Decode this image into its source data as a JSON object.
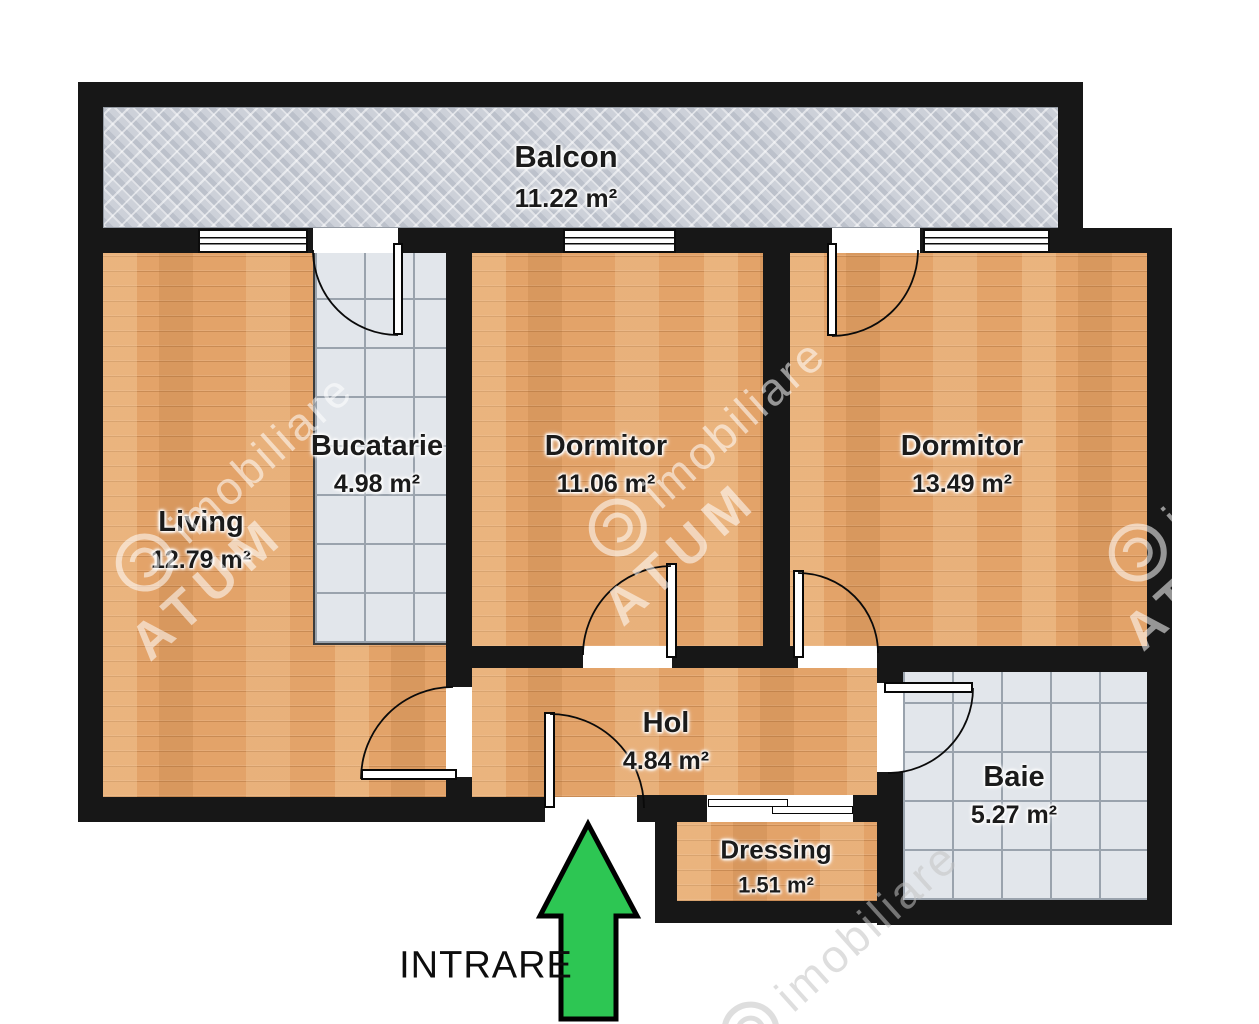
{
  "plan": {
    "entrance_label": "INTRARE",
    "rooms": [
      {
        "id": "balcon",
        "name": "Balcon",
        "area": "11.22 m²"
      },
      {
        "id": "living",
        "name": "Living",
        "area": "12.79 m²"
      },
      {
        "id": "bucatarie",
        "name": "Bucatarie",
        "area": "4.98 m²"
      },
      {
        "id": "dormitor1",
        "name": "Dormitor",
        "area": "11.06 m²"
      },
      {
        "id": "dormitor2",
        "name": "Dormitor",
        "area": "13.49 m²"
      },
      {
        "id": "hol",
        "name": "Hol",
        "area": "4.84 m²"
      },
      {
        "id": "baie",
        "name": "Baie",
        "area": "5.27 m²"
      },
      {
        "id": "dressing",
        "name": "Dressing",
        "area": "1.51 m²"
      }
    ]
  },
  "watermark": {
    "brand": "ATUM",
    "suffix": "imobiliare"
  },
  "colors": {
    "wall": "#171717",
    "wood": "#e3a369",
    "tile_bg": "#e2e6eb",
    "tile_grid": "#9aa3ad",
    "balcony_bg": "#c5cad3",
    "arrow_green": "#2dc653",
    "label_ink": "#1b1b1b"
  }
}
